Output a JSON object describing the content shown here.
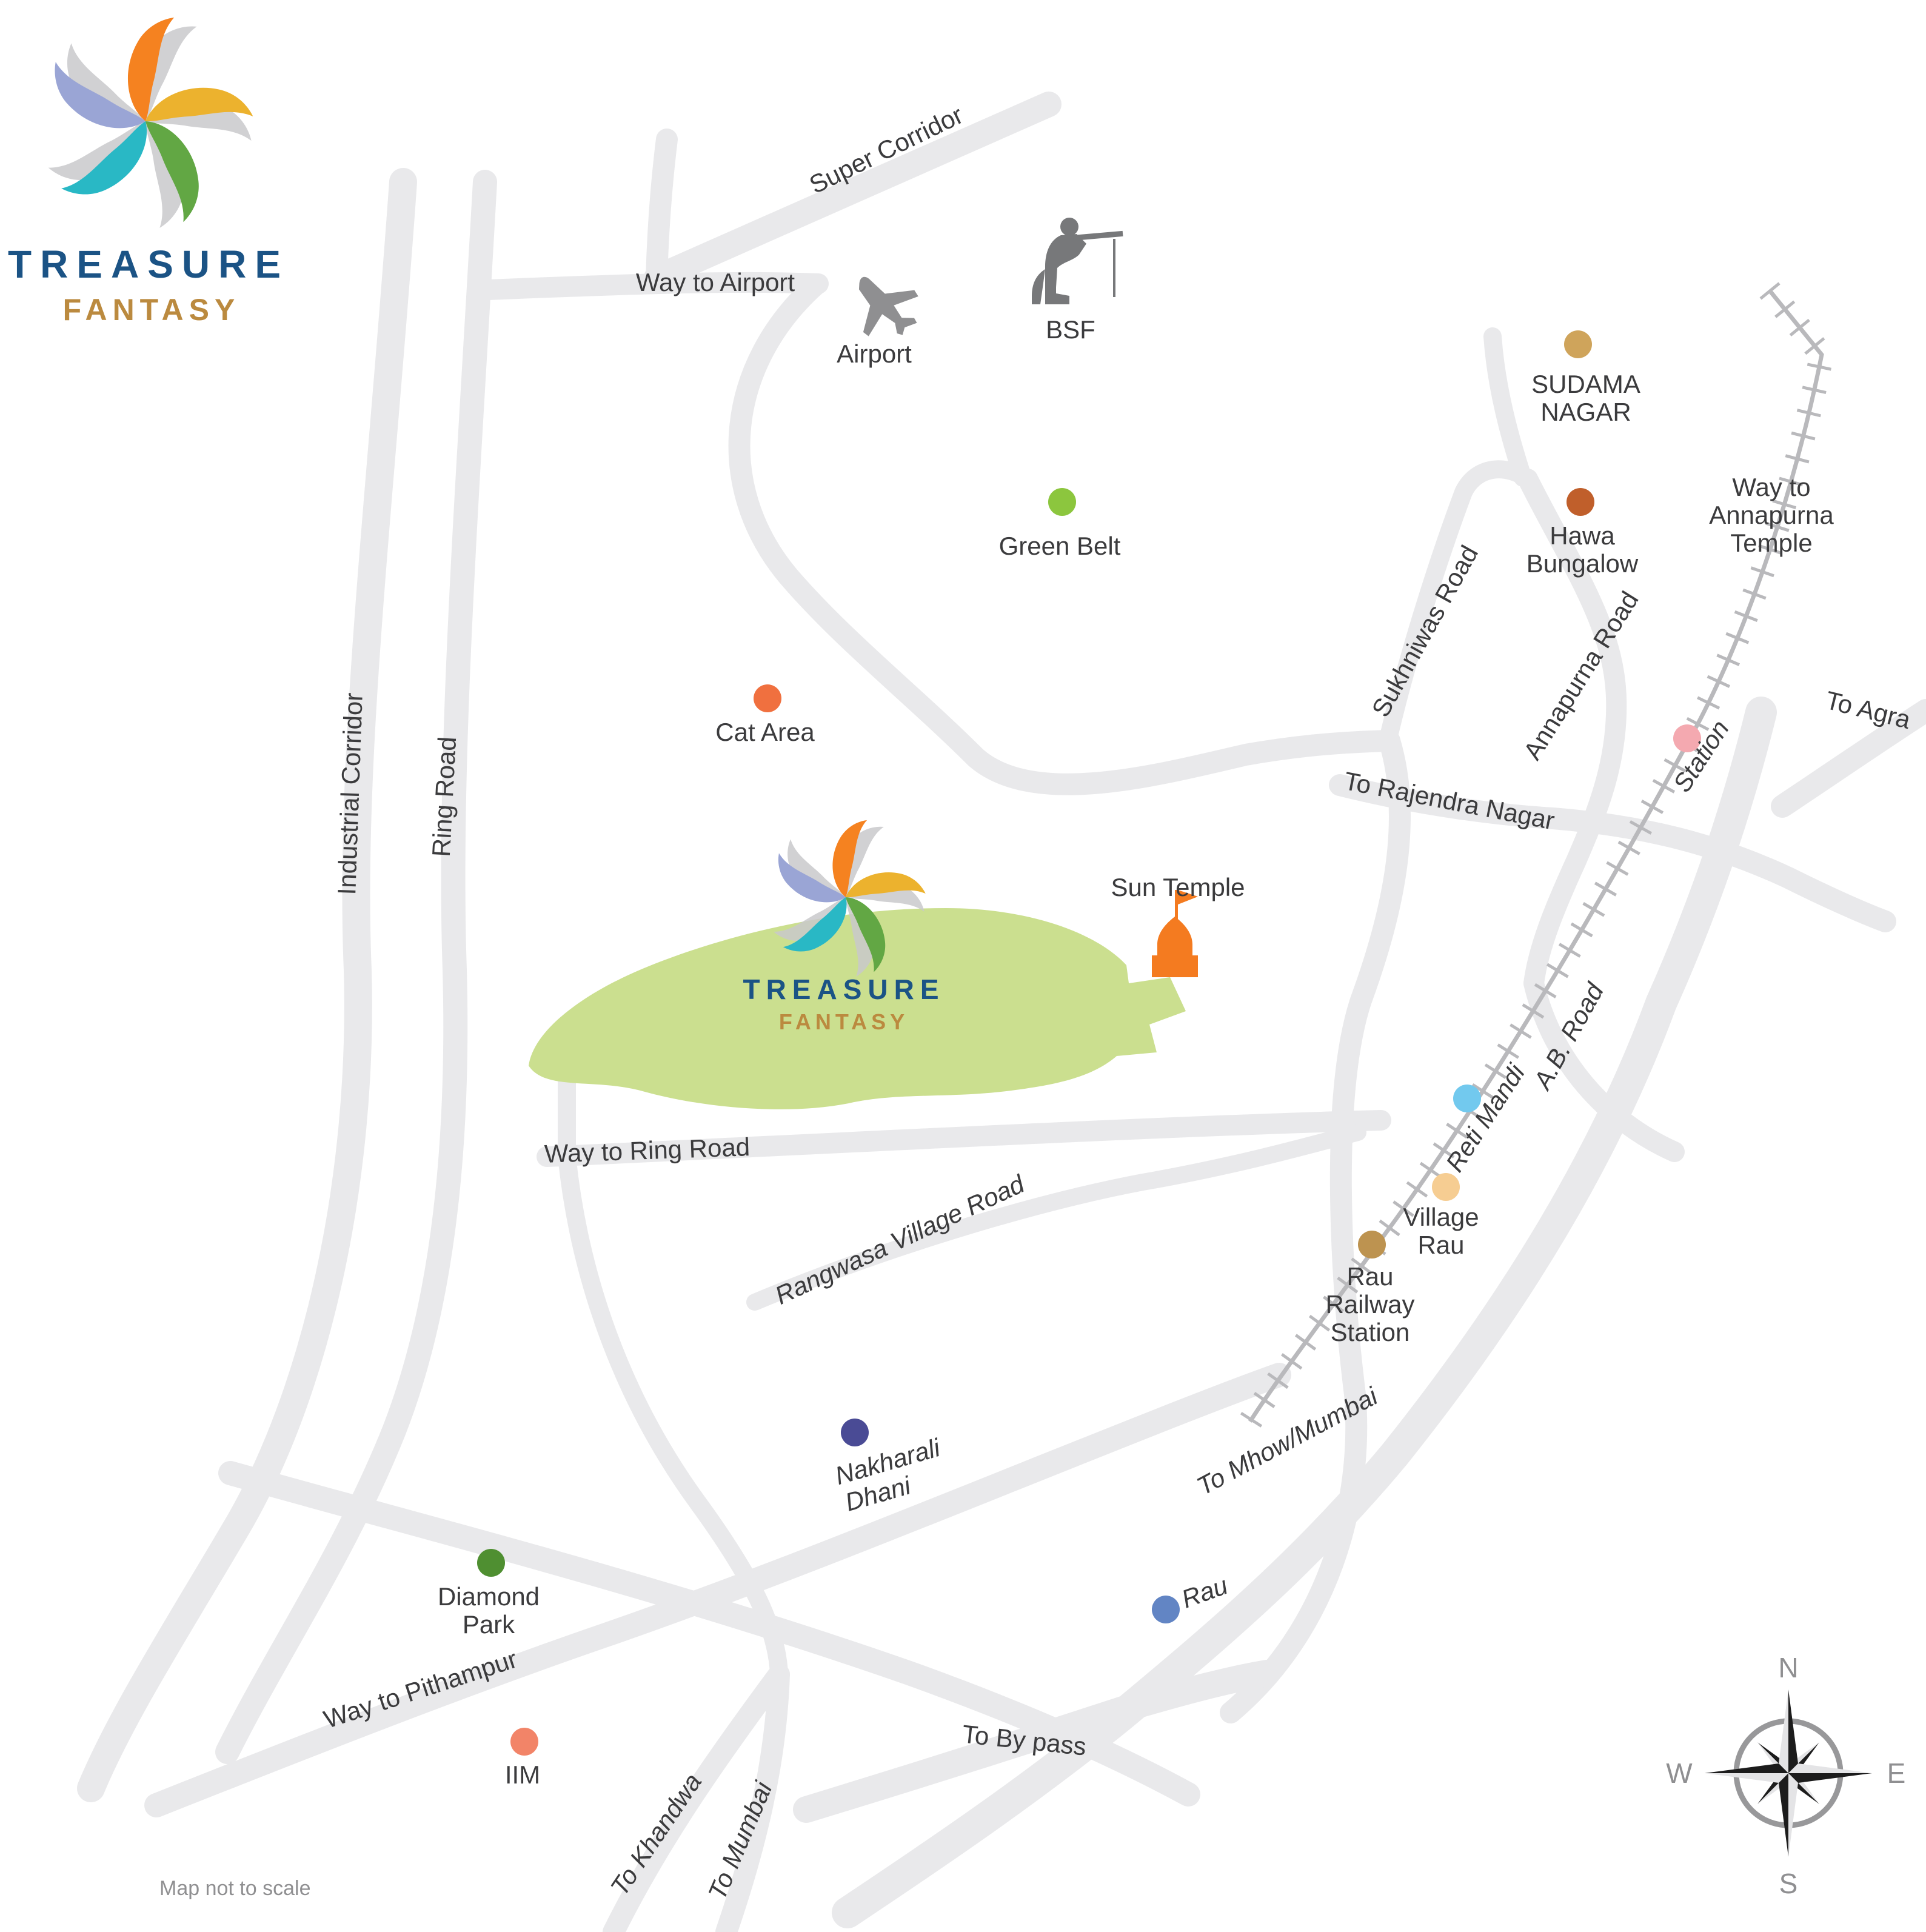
{
  "brand": {
    "treasure": "TREASURE",
    "fantasy": "FANTASY"
  },
  "site": {
    "treasure": "TREASURE",
    "fantasy": "FANTASY",
    "area_color": "#cbdf8f"
  },
  "roads": {
    "super_corridor": {
      "label": "Super Corridor"
    },
    "way_to_airport": {
      "label": "Way to Airport"
    },
    "industrial_corridor": {
      "label": "Industrial Corridor"
    },
    "ring_road": {
      "label": "Ring Road"
    },
    "sukhniwas_road": {
      "label": "Sukhniwas Road"
    },
    "annapurna_road": {
      "label": "Annapurna Road"
    },
    "to_rajendra_nagar": {
      "label": "To Rajendra Nagar"
    },
    "to_agra": {
      "label": "To Agra"
    },
    "ab_road": {
      "label": "A.B. Road"
    },
    "way_to_ring_road": {
      "label": "Way to Ring Road"
    },
    "rangwasa_village_road": {
      "label": "Rangwasa Village Road"
    },
    "to_mhow_mumbai": {
      "label": "To Mhow/Mumbai"
    },
    "way_to_pithampur": {
      "label": "Way to Pithampur"
    },
    "to_khandwa": {
      "label": "To Khandwa"
    },
    "to_mumbai": {
      "label": "To Mumbai"
    },
    "to_by_pass": {
      "label": "To By pass"
    }
  },
  "places": {
    "sudama_nagar": {
      "l1": "SUDAMA",
      "l2": "NAGAR",
      "color": "#cfa45b"
    },
    "hawa_bungalow": {
      "l1": "Hawa",
      "l2": "Bungalow",
      "color": "#c05f2b"
    },
    "green_belt": {
      "label": "Green Belt",
      "color": "#8cc63e"
    },
    "cat_area": {
      "label": "Cat Area",
      "color": "#f0703f"
    },
    "station": {
      "label": "Station",
      "color": "#f4a9b0"
    },
    "reti_mandi": {
      "label": "Reti Mandi",
      "color": "#72c9ee"
    },
    "village_rau": {
      "l1": "Village",
      "l2": "Rau",
      "color": "#f6cd92"
    },
    "rau_railway_station": {
      "l1": "Rau",
      "l2": "Railway",
      "l3": "Station",
      "color": "#bd9350"
    },
    "nakharali_dhani": {
      "l1": "Nakharali",
      "l2": "Dhani",
      "color": "#4a4b95"
    },
    "rau": {
      "label": "Rau",
      "color": "#6285c4"
    },
    "diamond_park": {
      "l1": "Diamond",
      "l2": "Park",
      "color": "#4f8f31"
    },
    "iim": {
      "label": "IIM",
      "color": "#f28468"
    },
    "airport": {
      "label": "Airport"
    },
    "bsf": {
      "label": "BSF"
    },
    "sun_temple": {
      "label": "Sun Temple",
      "icon_color": "#f47b20"
    },
    "way_to_annapurna_temple": {
      "l1": "Way to",
      "l2": "Annapurna",
      "l3": "Temple"
    }
  },
  "compass": {
    "n": "N",
    "e": "E",
    "s": "S",
    "w": "W"
  },
  "footer": {
    "disclaimer": "Map not to scale"
  },
  "colors": {
    "road": "#e9e9eb",
    "railway": "#b9b9bc",
    "logo_orange": "#f58220",
    "logo_yellow": "#ecb22e",
    "logo_green": "#62a744",
    "logo_teal": "#29b8c5",
    "logo_lavender": "#9aa5d5",
    "brand_blue": "#1b5385",
    "brand_gold": "#bb8a3f"
  }
}
